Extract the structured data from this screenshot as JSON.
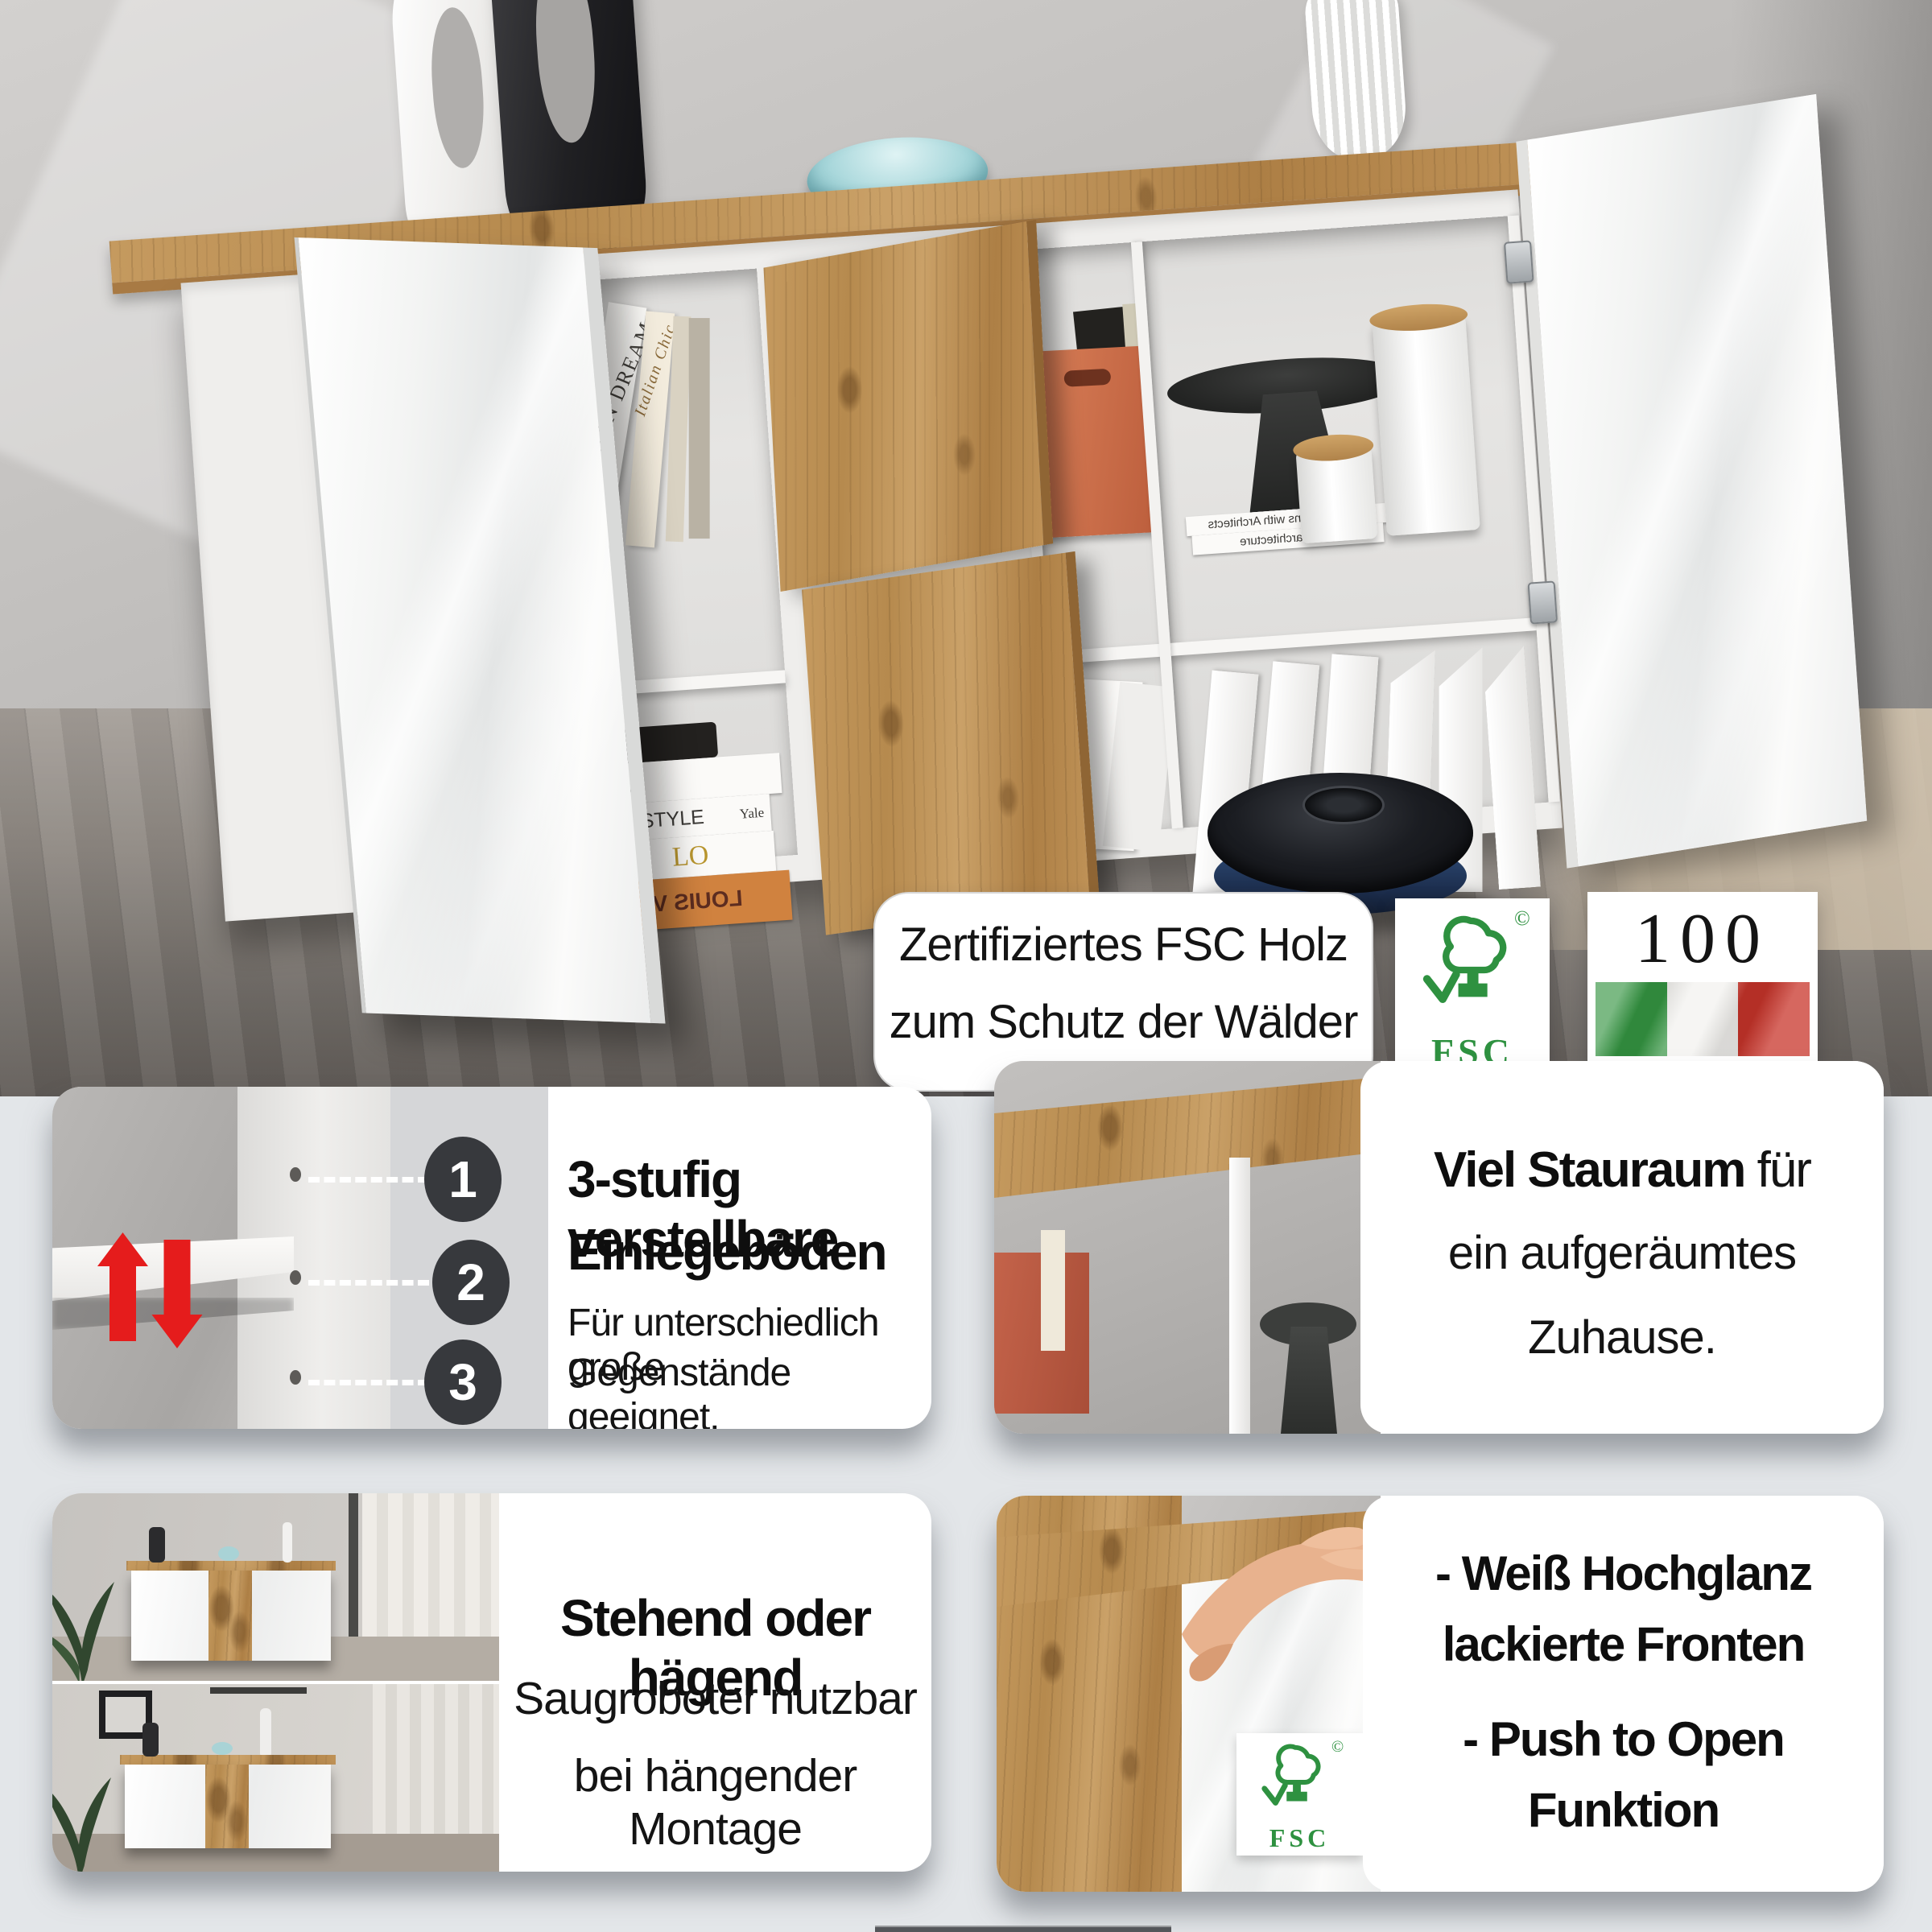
{
  "photo": {
    "badge": {
      "line1": "Zertifiziertes FSC Holz",
      "line2": "zum Schutz der Wälder"
    },
    "fsc_badge": {
      "label": "FSC",
      "copyright": "©"
    },
    "italy_badge": {
      "percent": "100 %",
      "label": "MADE IN ITALY"
    },
    "books": {
      "spine_vertical": "ITALIAN DREAM",
      "spine_vertical2": "Italian Chic",
      "stack1": "L",
      "stack2": "STYLE",
      "stack2_side": "Yale",
      "stack3": "LO",
      "stack4": "LOUIS V",
      "flat1": "Conversations with Architects",
      "flat2": "arts e architecture"
    }
  },
  "panel_shelves": {
    "num1": "1",
    "num2": "2",
    "num3": "3",
    "title1": "3-stufig verstellbare",
    "title2": "Einlegeböden",
    "body1": "Für unterschiedlich große",
    "body2": "Gegenstände geeignet."
  },
  "panel_storage": {
    "title_bold": "Viel Stauraum",
    "title_rest": " für",
    "line2": "ein aufgeräumtes",
    "line3": "Zuhause."
  },
  "panel_mounting": {
    "title": "Stehend oder hägend",
    "line2": "Saugroboter nutzbar",
    "line3": "bei hängender Montage"
  },
  "panel_features": {
    "item1_line1": "- Weiß Hochglanz",
    "item1_line2": "lackierte Fronten",
    "item2_line1": "- Push to Open",
    "item2_line2": "Funktion",
    "fsc_label": "FSC",
    "fsc_copyright": "©"
  },
  "colors": {
    "fsc_green": "#2e9140",
    "italy_green": "#349441",
    "italy_red": "#c8342a",
    "arrow_red": "#e51c1c",
    "step_circle": "#37393d"
  }
}
